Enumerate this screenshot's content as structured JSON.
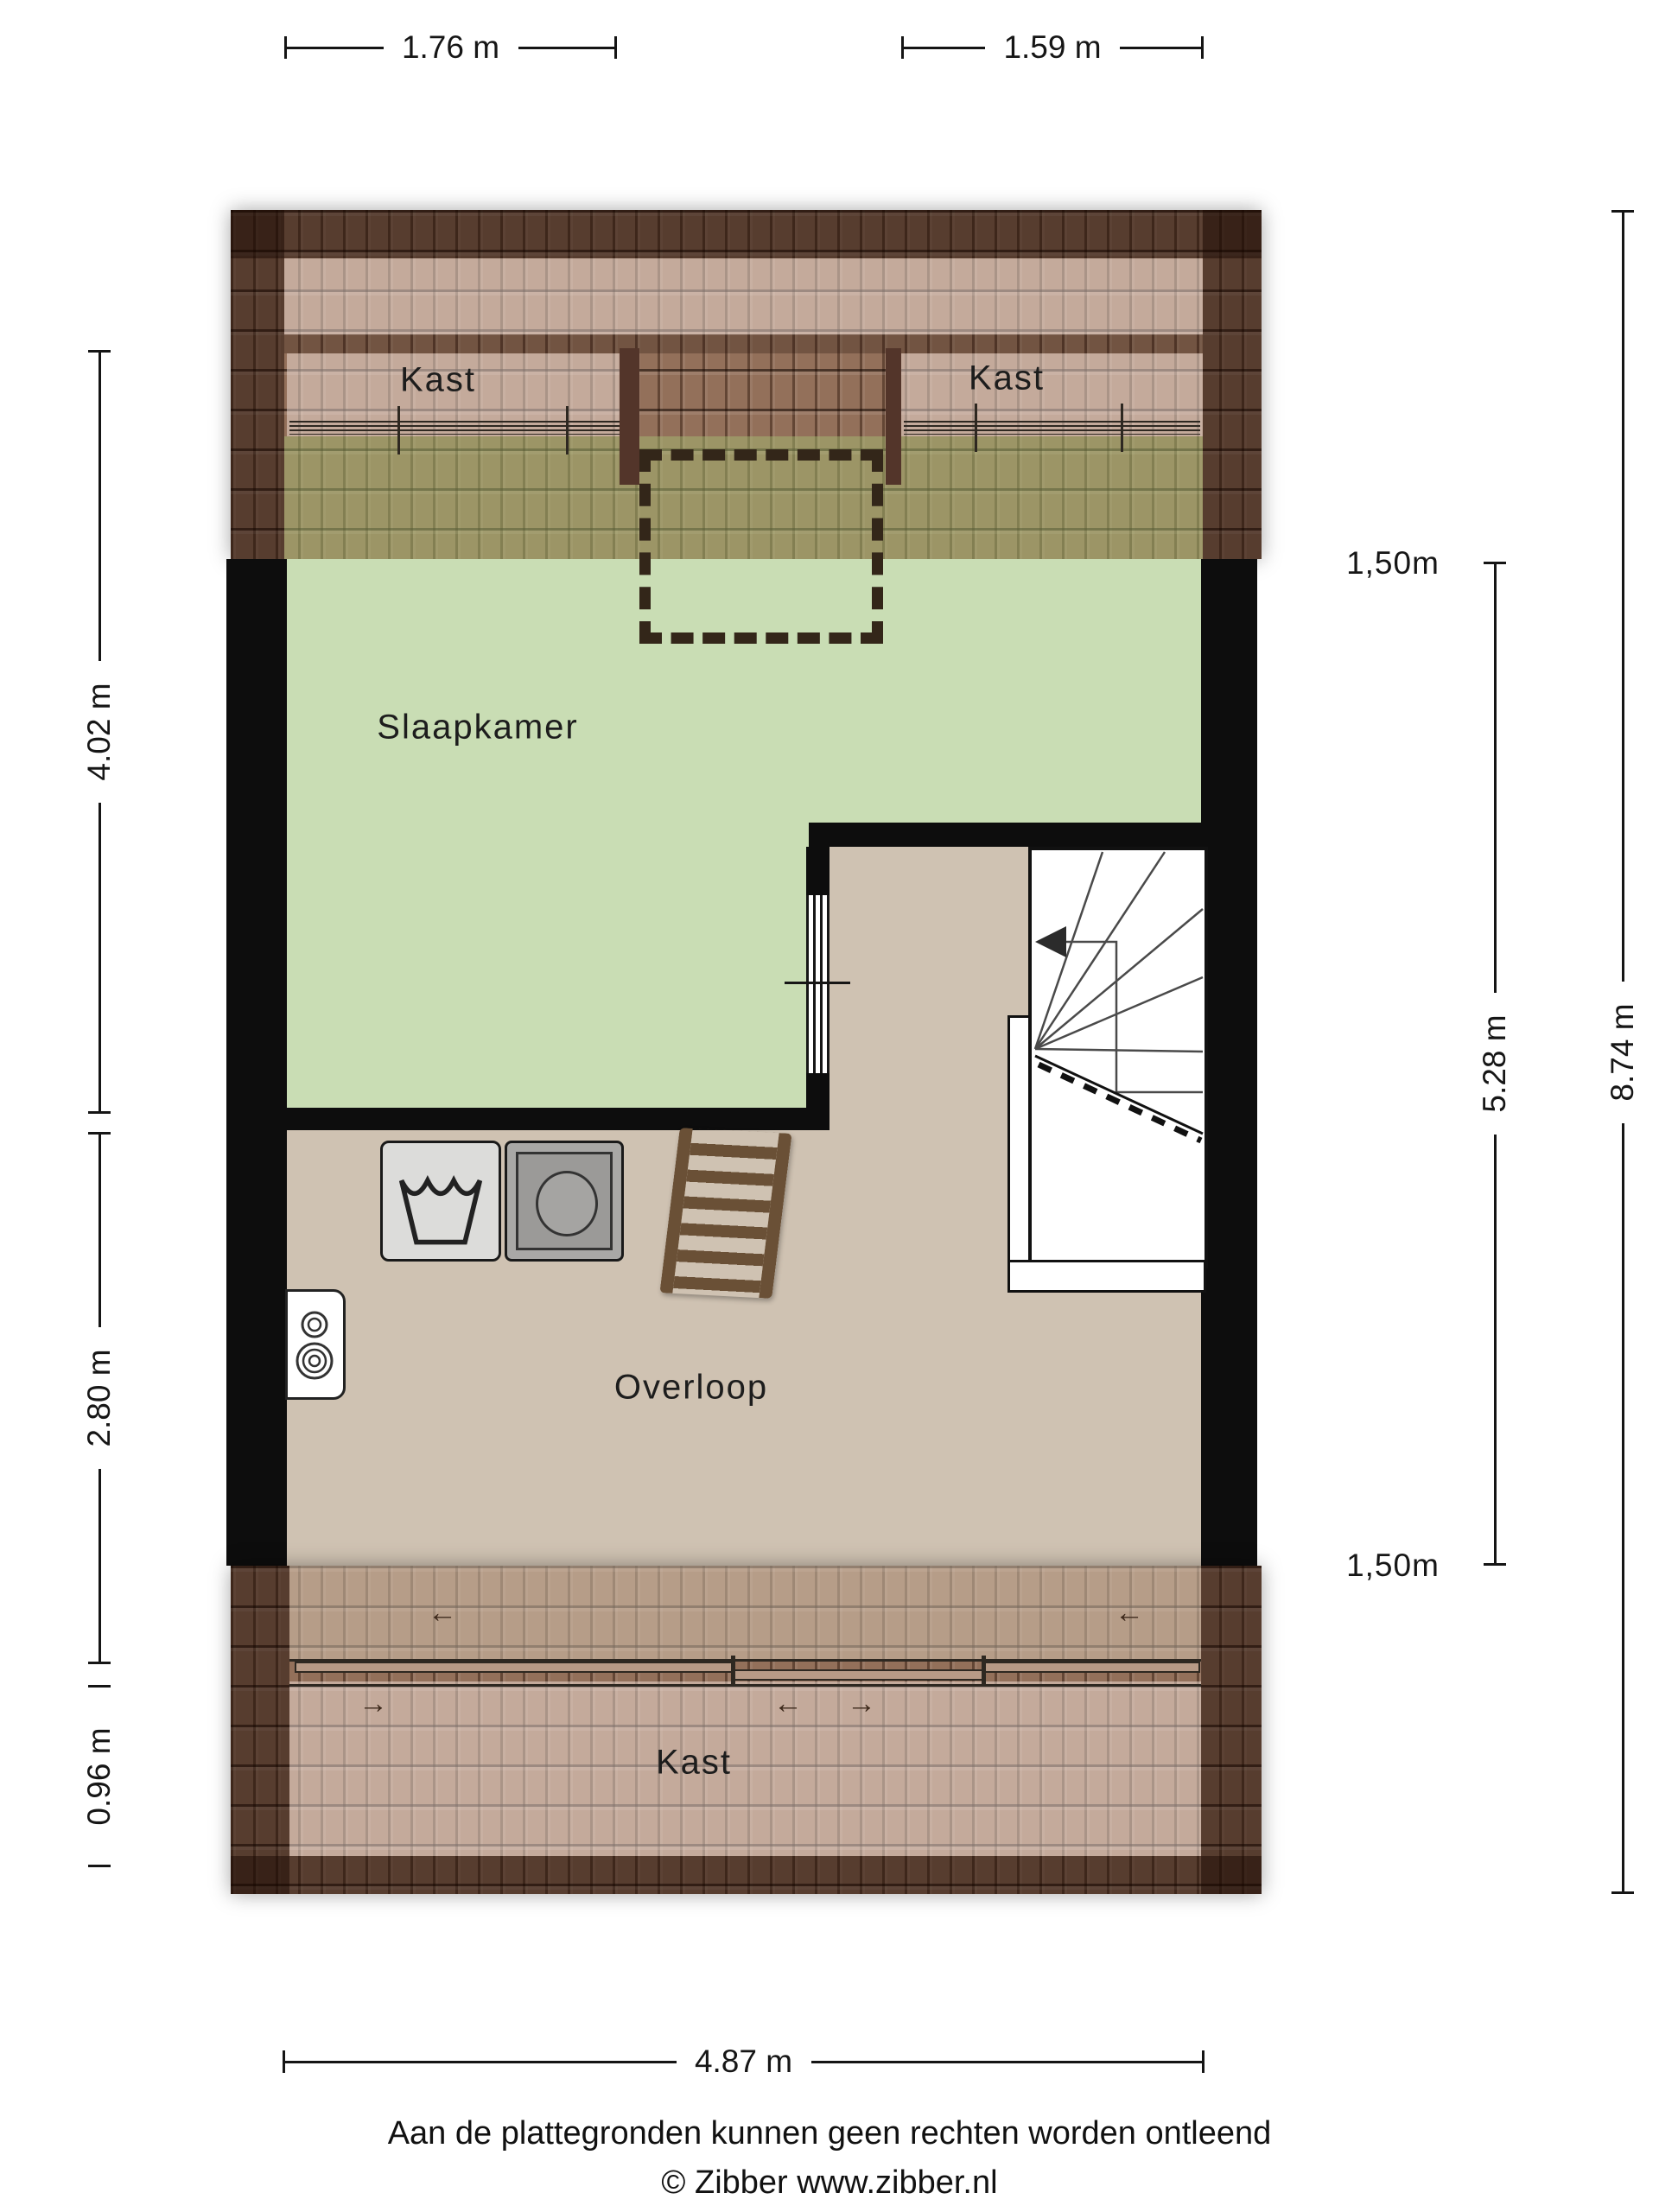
{
  "rooms": {
    "slaapkamer": {
      "label": "Slaapkamer"
    },
    "overloop": {
      "label": "Overloop"
    },
    "kast_top_left": {
      "label": "Kast"
    },
    "kast_top_right": {
      "label": "Kast"
    },
    "kast_bottom": {
      "label": "Kast"
    }
  },
  "dimensions": {
    "top_left": "1.76 m",
    "top_right": "1.59 m",
    "left_upper": "4.02 m",
    "left_middle": "2.80 m",
    "left_lower": "0.96 m",
    "right_headroom_top": "1,50m",
    "right_span": "5.28 m",
    "right_headroom_bottom": "1,50m",
    "right_total": "8.74 m",
    "bottom": "4.87 m"
  },
  "annotations": {
    "slide_left": "←",
    "slide_right": "→"
  },
  "footer": {
    "disclaimer": "Aan de plattegronden kunnen geen rechten worden ontleend",
    "copyright": "© Zibber www.zibber.nl"
  },
  "colors": {
    "floor_green": "#c9ddb4",
    "floor_tan": "#cfc2b2",
    "roof_base": "#93705a",
    "wall": "#0d0d0d",
    "wood_wall": "#53352a",
    "dash": "#332619",
    "ladder_wood": "#6a5036"
  }
}
